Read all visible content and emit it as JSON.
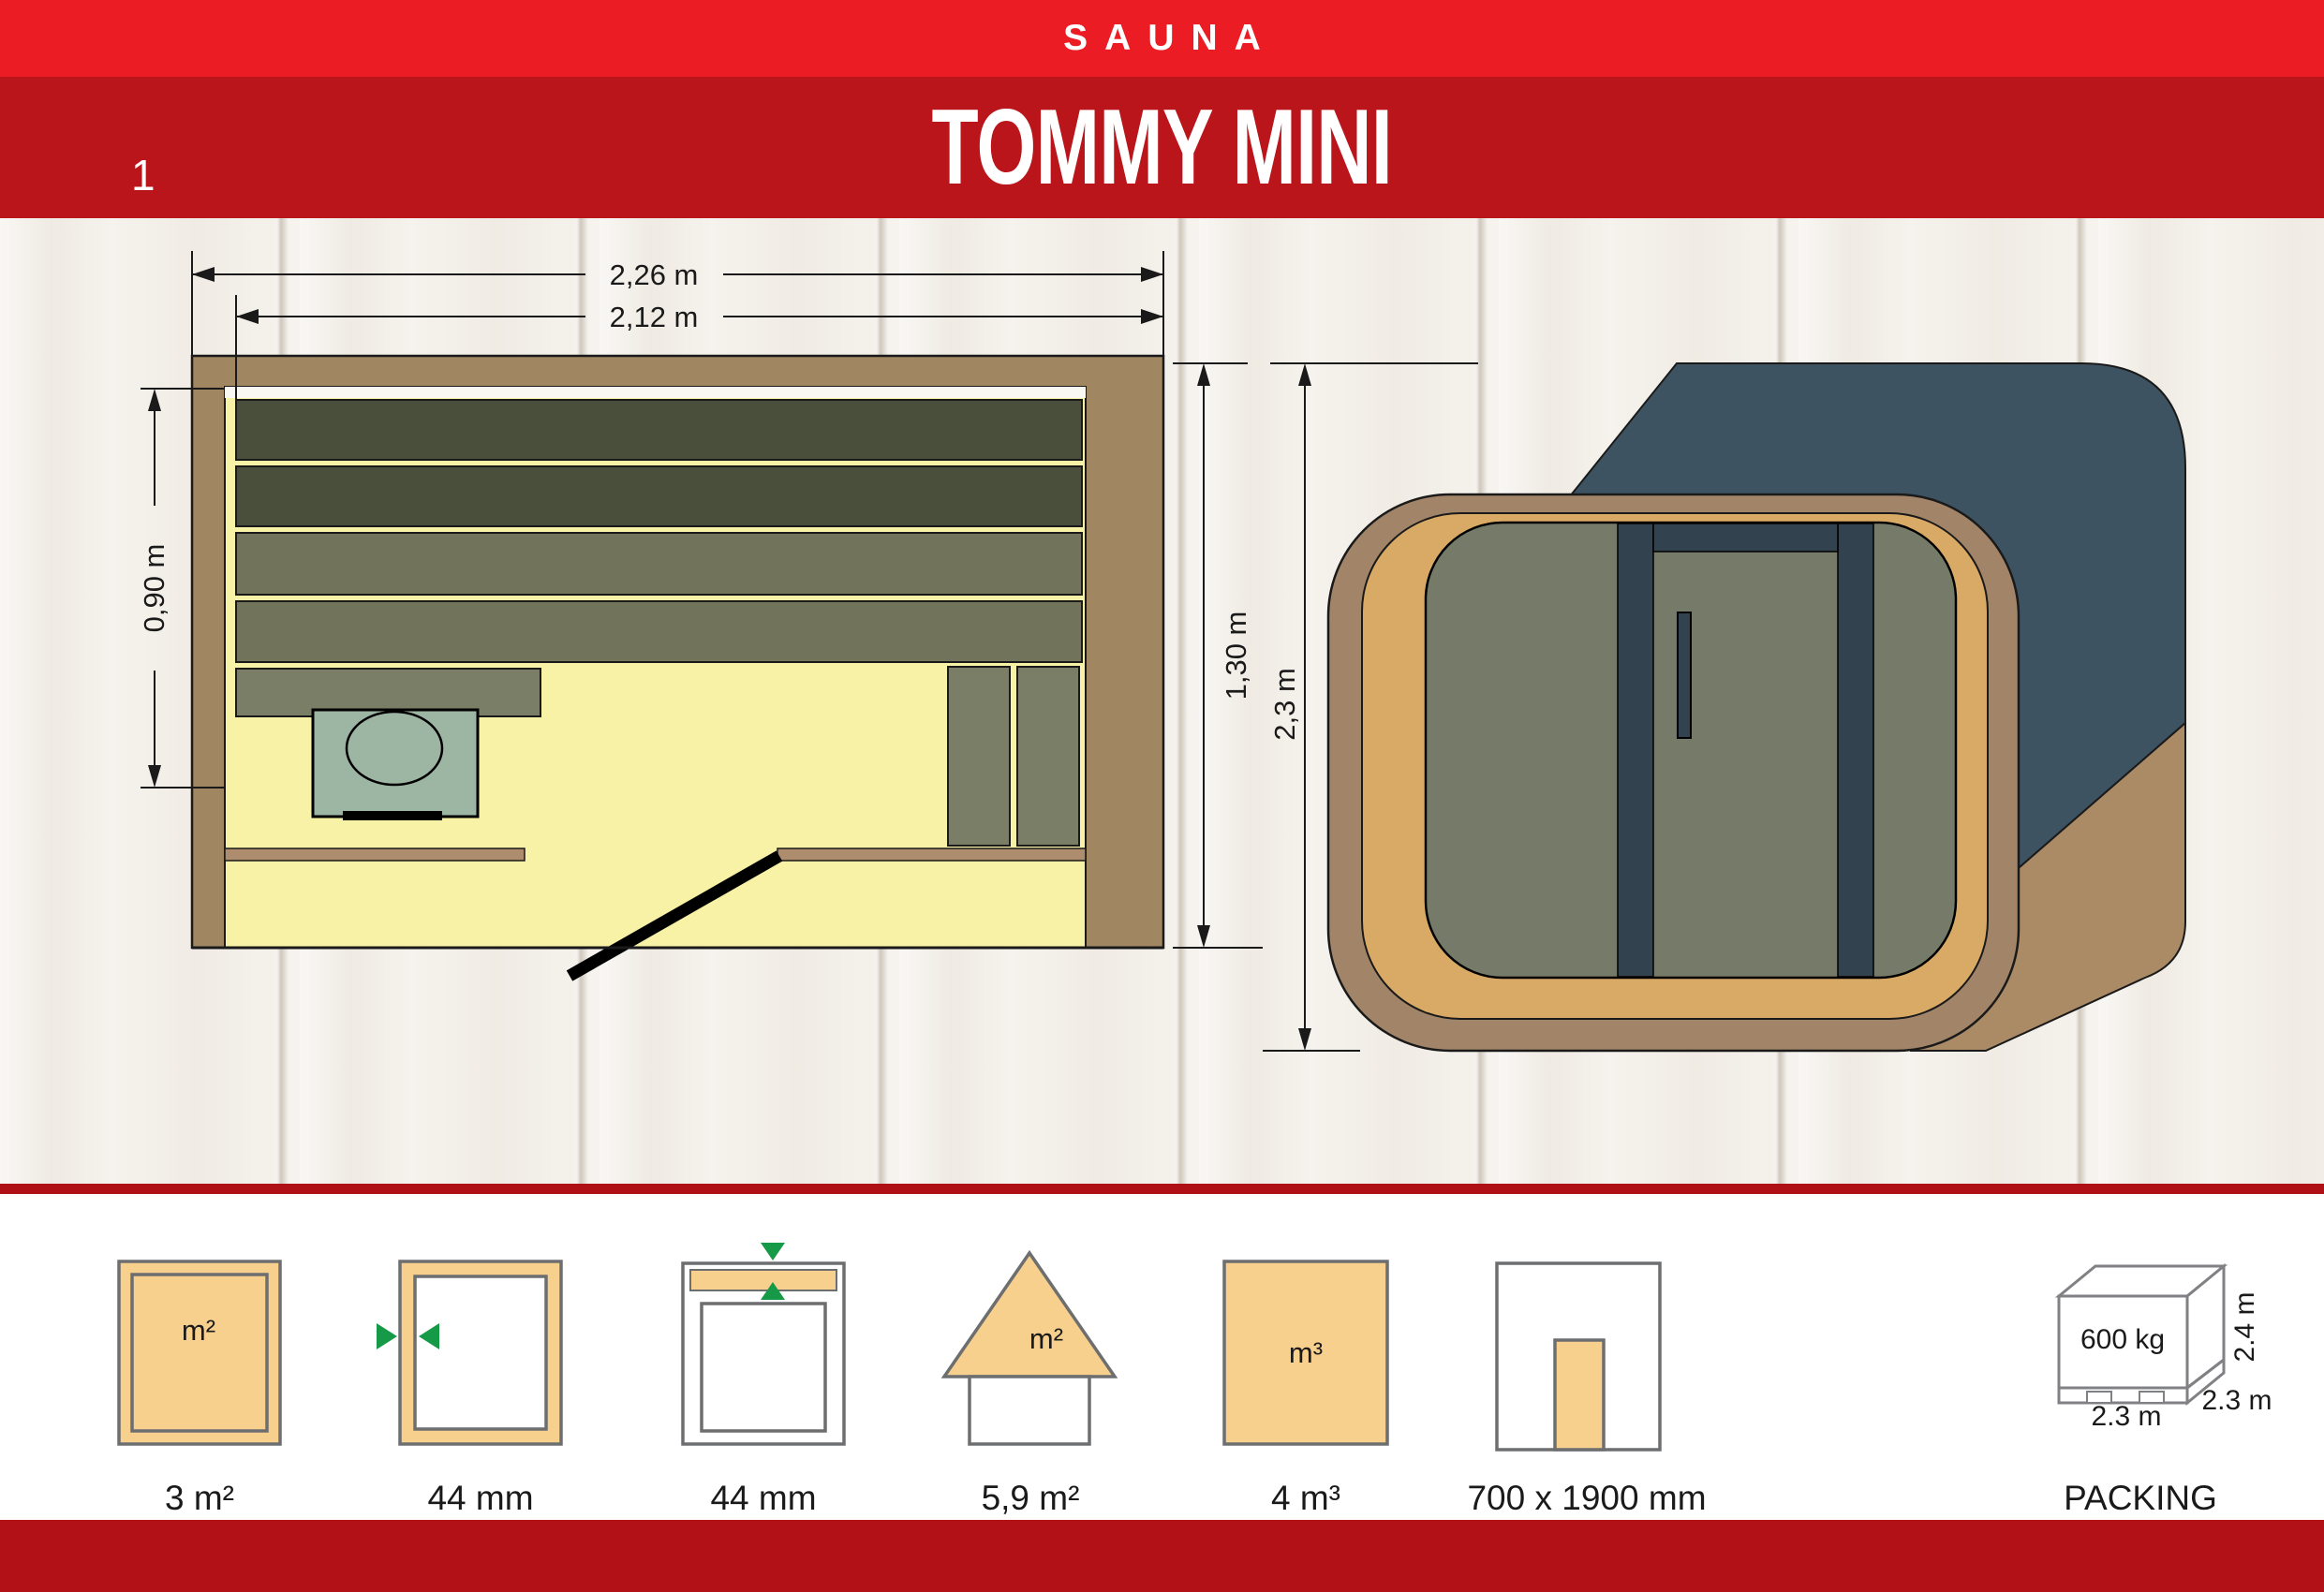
{
  "header": {
    "brand": "SAUNA",
    "title": "TOMMY MINI",
    "page_number": "1"
  },
  "floor_plan": {
    "outer_width": "2,26 m",
    "inner_width": "2,12 m",
    "bench_depth": "0,90 m",
    "inner_depth": "1,30 m"
  },
  "side_view": {
    "height": "2,3 m"
  },
  "specs": [
    {
      "id": "floor-area",
      "icon": "area-icon",
      "symbol": "m²",
      "label": "3 m²"
    },
    {
      "id": "wall-thickness",
      "icon": "wall-thickness-icon",
      "label": "44 mm"
    },
    {
      "id": "roof-thickness",
      "icon": "roof-thickness-icon",
      "label": "44 mm"
    },
    {
      "id": "roof-area",
      "icon": "roof-area-icon",
      "symbol": "m²",
      "label": "5,9 m²"
    },
    {
      "id": "volume",
      "icon": "volume-icon",
      "symbol": "m³",
      "label": "4 m³"
    },
    {
      "id": "door-size",
      "icon": "door-size-icon",
      "label": "700 x 1900 mm"
    },
    {
      "id": "packing",
      "icon": "packing-icon",
      "label": "PACKING",
      "weight": "600 kg",
      "height": "2.4 m",
      "depth": "2.3 m",
      "width": "2.3 m"
    }
  ],
  "colors": {
    "brand_red": "#ec1c24",
    "title_band_red": "#bb151c",
    "footer_red": "#b11117",
    "wall_brown": "#a08661",
    "floor_yellow": "#f8f2a6",
    "bench_dark": "#4a4f3b",
    "bench_mid": "#71745a",
    "stove_green": "#9cb6a3",
    "cube_slate": "#3d5362",
    "glass_olive": "#767b69",
    "frame_tan": "#d9aa66",
    "icon_tan": "#f8d08e",
    "icon_green": "#169a47"
  }
}
